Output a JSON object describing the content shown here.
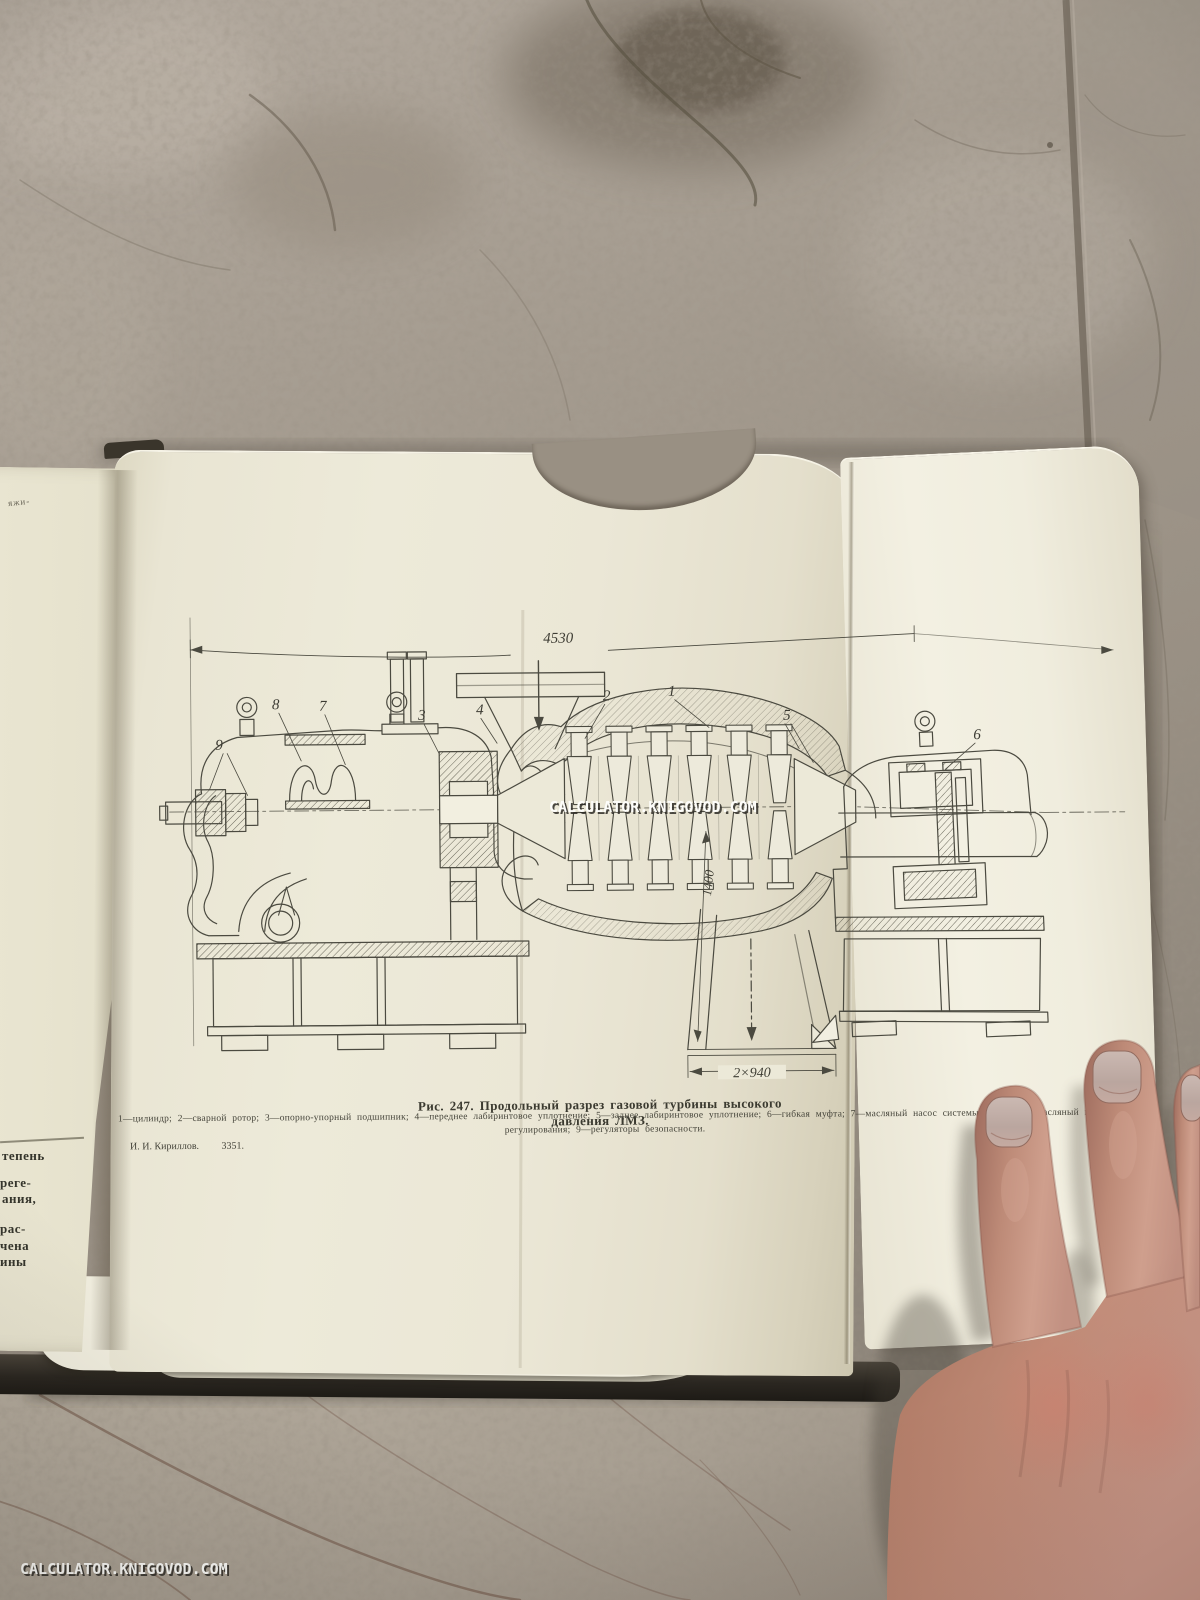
{
  "photo": {
    "watermark_center": "CALCULATOR.KNIGOVOD.COM",
    "watermark_bottom_left": "CALCULATOR.KNIGOVOD.COM"
  },
  "figure": {
    "caption": "Рис. 247. Продольный разрез газовой турбины высокого давления ЛМЗ.",
    "legend_line1": "1—цилиндр; 2—сварной ротор; 3—опорно-упорный подшипник; 4—переднее лабиринтовое уплотнение; 5—заднее лабиринтовое уплотнение; 6—гибкая муфта; 7—масляный насос системы смазки; 8—масляный насос системы",
    "legend_line2": "регулирования; 9—регуляторы безопасности.",
    "printer_author": "И. И. Кириллов.",
    "printer_number": "3351.",
    "dim_length": "4530",
    "dim_height": "1400",
    "dim_width": "2×940",
    "callouts": [
      "1",
      "2",
      "3",
      "4",
      "5",
      "6",
      "7",
      "8",
      "9"
    ]
  },
  "left_page": {
    "top_fragment": "яжи-",
    "fragments": [
      "тепень",
      "реге-",
      "ания,",
      "рас-",
      "чена",
      "ины"
    ]
  },
  "colors": {
    "paper": "#ece9d8",
    "paper_right": "#f1eee0",
    "ink": "#46453c",
    "marble": "#a59c90",
    "skin": "#c09180"
  }
}
